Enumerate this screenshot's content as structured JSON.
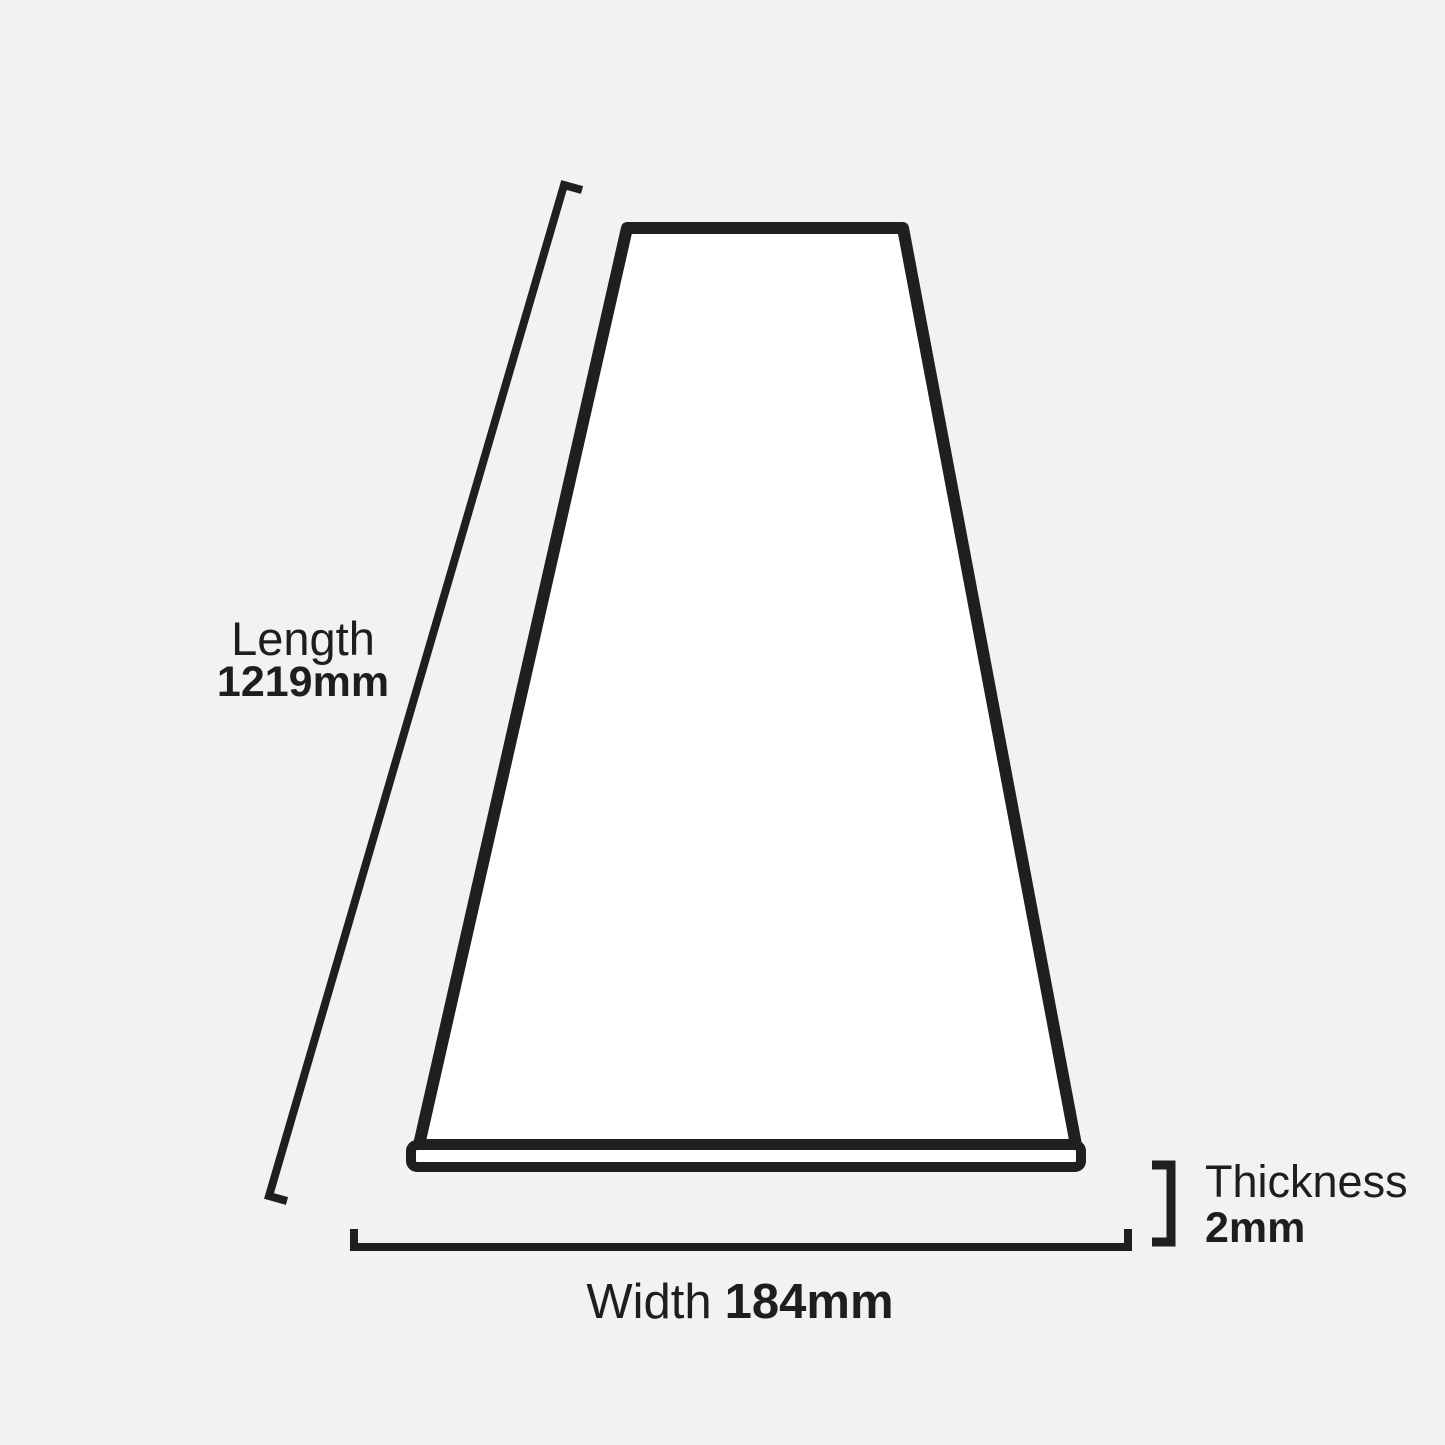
{
  "page": {
    "background_color": "#f2f2f2",
    "text_color": "#1e1e1e"
  },
  "illustration": {
    "subject": "plank-perspective-view",
    "fill_color": "#ffffff",
    "outline_color": "#1f1f1f"
  },
  "dimensions": {
    "length": {
      "label": "Length",
      "value": "1219mm"
    },
    "width": {
      "label": "Width",
      "value": "184mm"
    },
    "thickness": {
      "label": "Thickness",
      "value": "2mm"
    }
  }
}
